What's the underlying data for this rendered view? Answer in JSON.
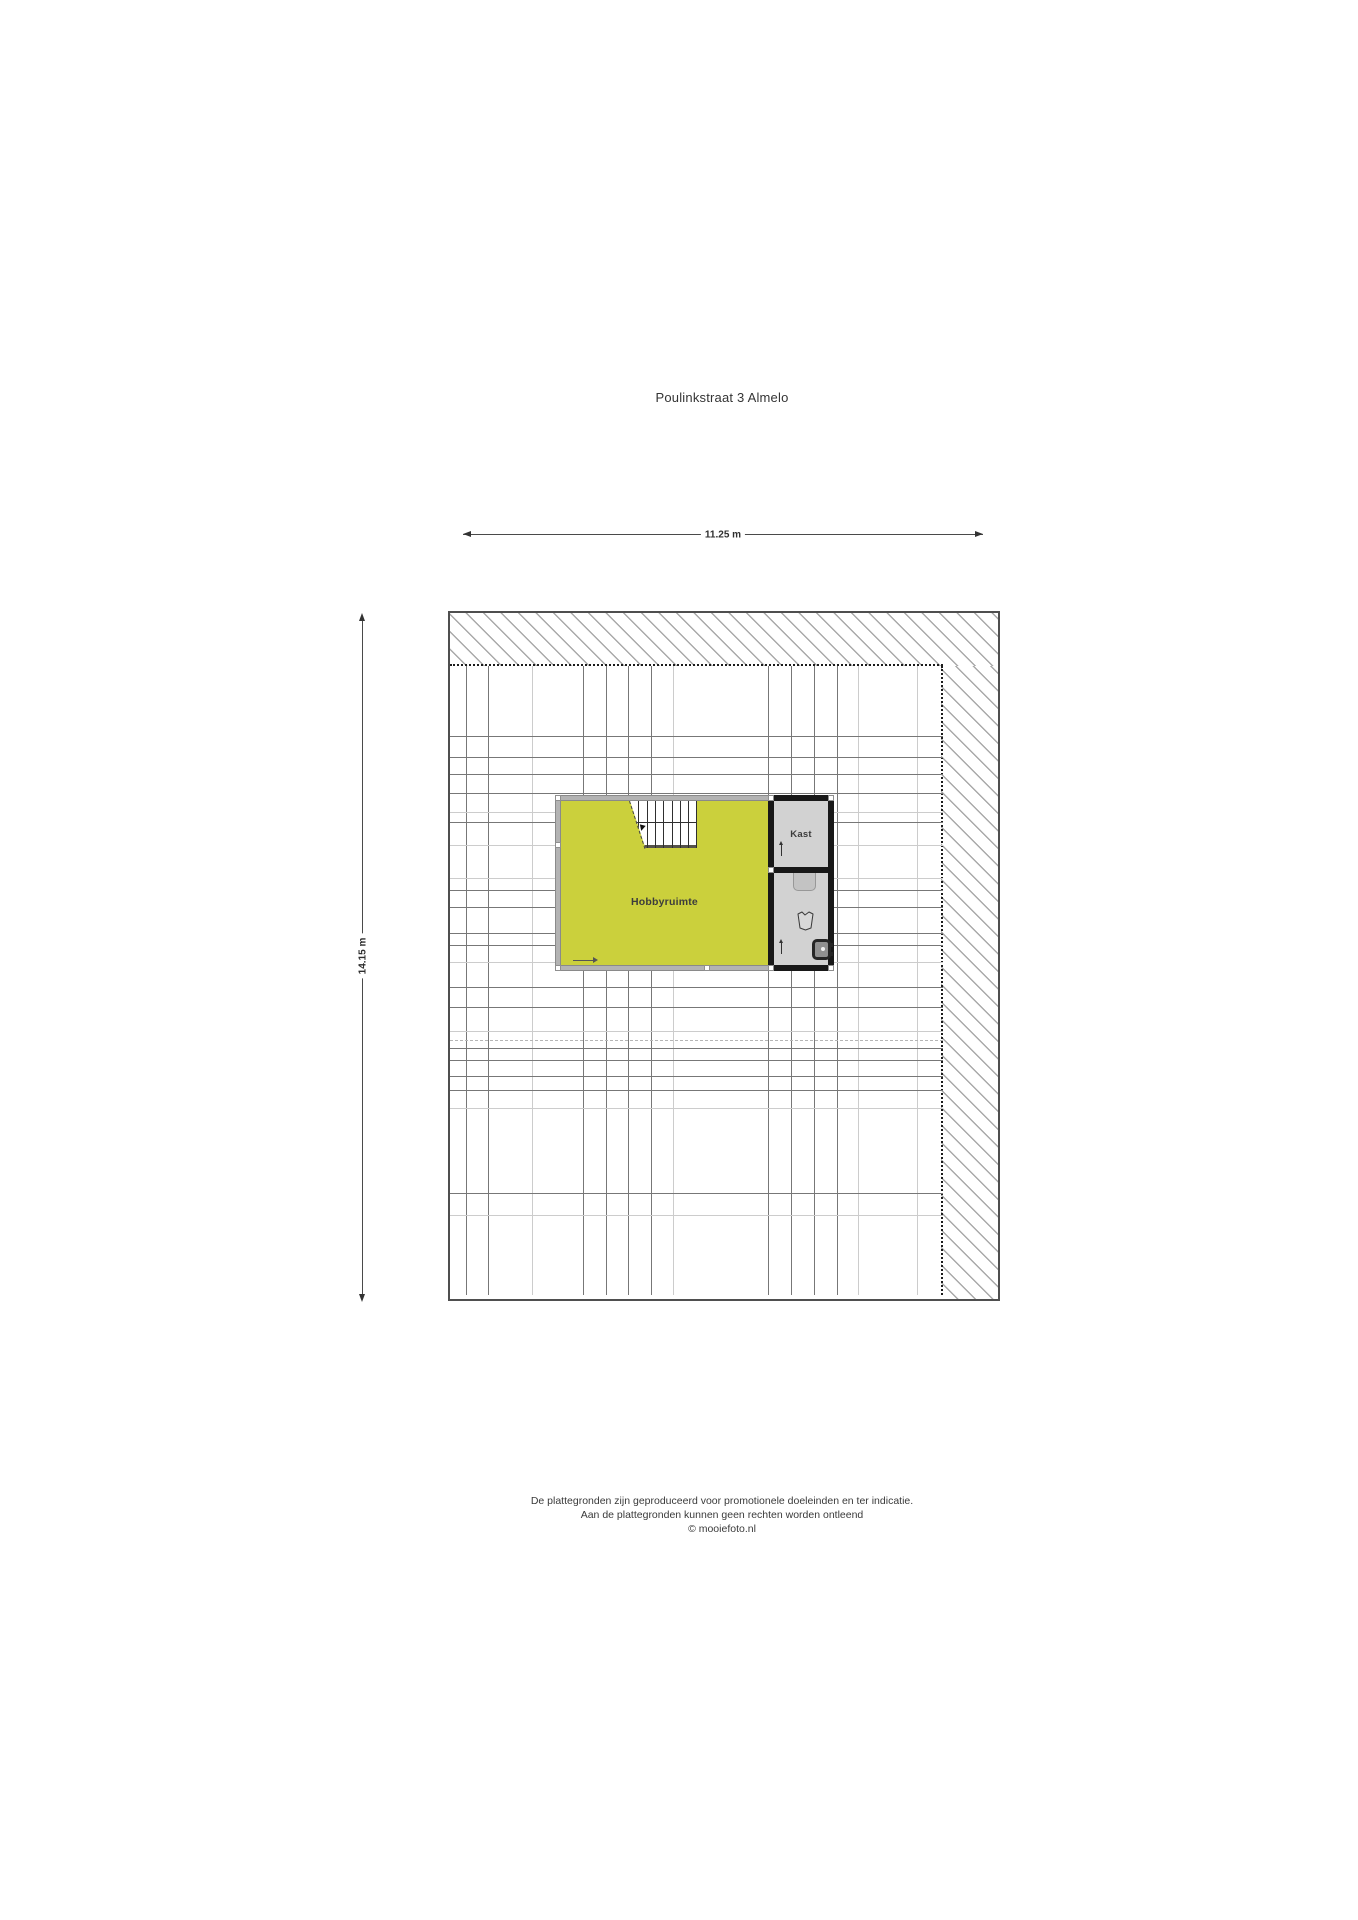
{
  "title": "Poulinkstraat 3 Almelo",
  "dimensions": {
    "width": "11.25 m",
    "height": "14.15 m"
  },
  "rooms": {
    "hobby": "Hobbyruimte",
    "closet": "Kast"
  },
  "footer": {
    "line1": "De plattegronden zijn geproduceerd voor promotionele doeleinden en ter indicatie.",
    "line2": "Aan de plattegronden kunnen geen rechten worden ontleend",
    "line3": "© mooiefoto.nl"
  },
  "colors": {
    "hobby_room_fill": "#cbd03c",
    "closet_floor": "#d2d2d2",
    "wall_gray": "#b3b3b3",
    "wall_black": "#181818",
    "hatch_line": "#a9a9a9",
    "grid_dark": "#777777",
    "grid_light": "#cccccc"
  }
}
